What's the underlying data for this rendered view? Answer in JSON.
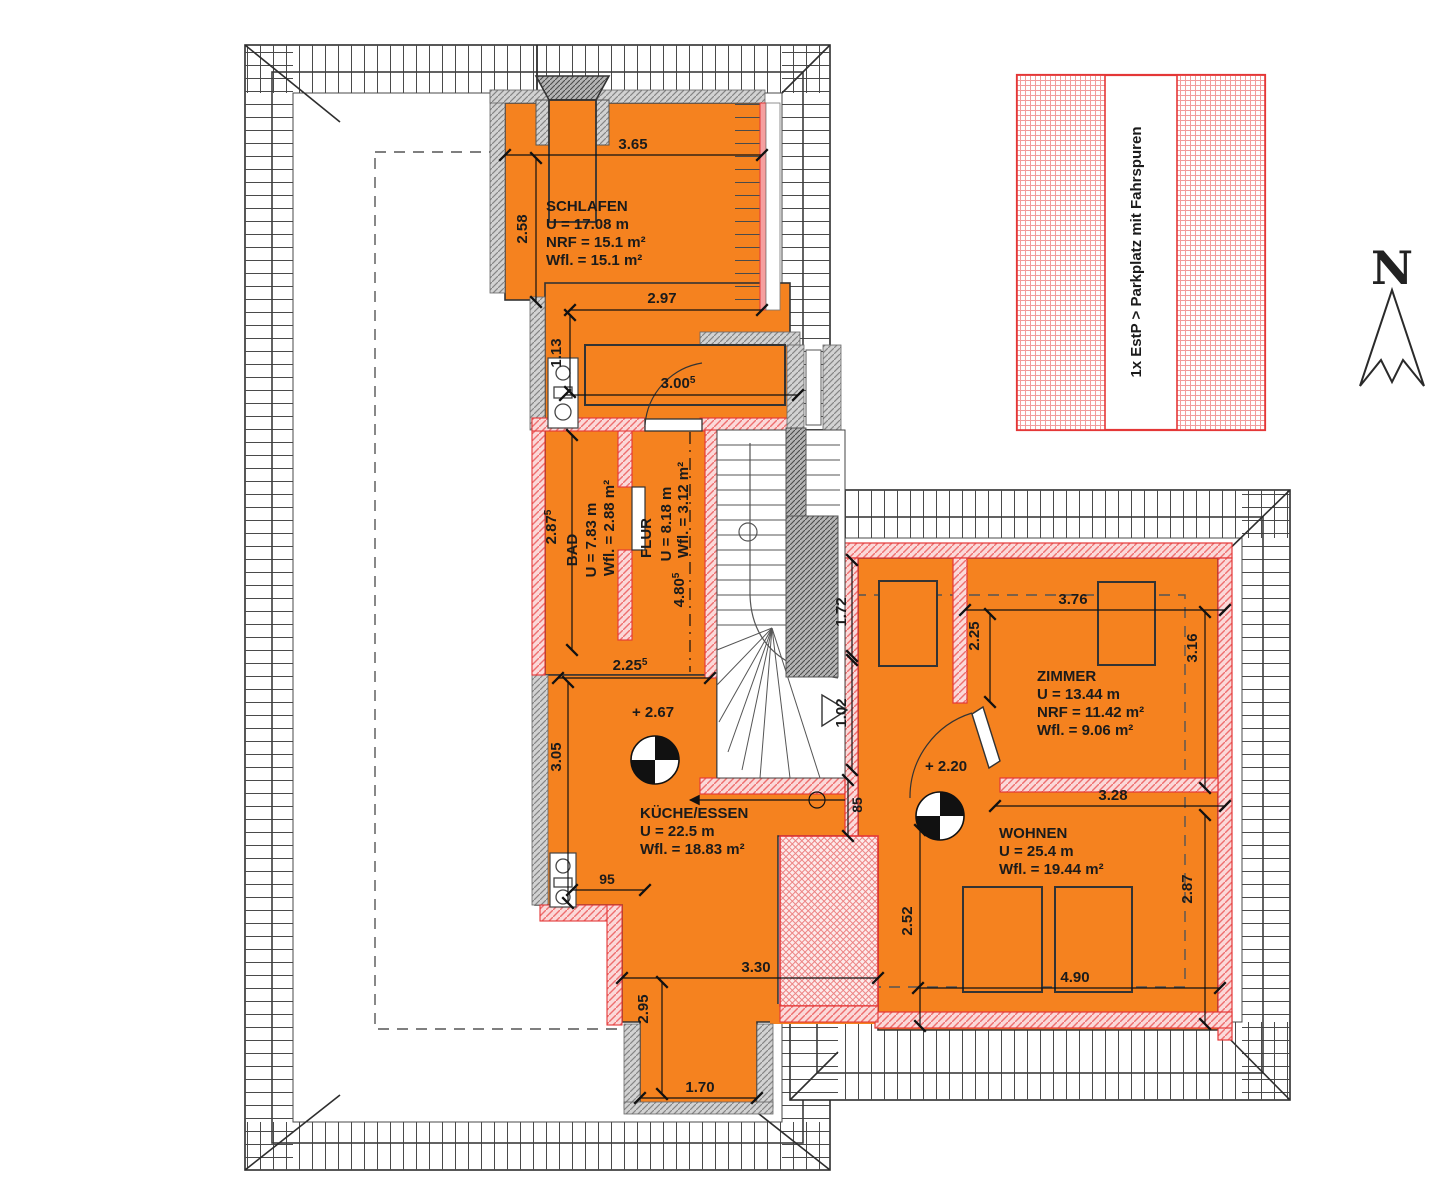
{
  "compass": {
    "label": "N"
  },
  "legend": {
    "parking": "1x EstP > Parkplatz mit Fahrspuren"
  },
  "levels": {
    "kueche": "+ 2.67",
    "diele": "+ 2.20"
  },
  "rooms": {
    "schlafen": {
      "name": "SCHLAFEN",
      "l1": "U = 17.08 m",
      "l2": "NRF = 15.1 m²",
      "l3": "Wfl. = 15.1 m²"
    },
    "bad": {
      "name": "BAD",
      "l1": "U = 7.83 m",
      "l2": "Wfl. = 2.88 m²"
    },
    "flur": {
      "name": "FLUR",
      "l1": "U = 8.18 m",
      "l2": "Wfl. = 3.12 m²"
    },
    "kueche": {
      "name": "KÜCHE/ESSEN",
      "l1": "U = 22.5 m",
      "l2": "Wfl. = 18.83 m²"
    },
    "zimmer": {
      "name": "ZIMMER",
      "l1": "U = 13.44 m",
      "l2": "NRF = 11.42 m²",
      "l3": "Wfl. = 9.06 m²"
    },
    "wohnen": {
      "name": "WOHNEN",
      "l1": "U = 25.4 m",
      "l2": "Wfl. = 19.44 m²"
    }
  },
  "dims": {
    "schlafen_top": "3.65",
    "schlafen_left": "2.58",
    "schlafen_inner": "2.97",
    "schlafen_step": "1.13",
    "wardrobe": {
      "v": "3.00",
      "s": "5"
    },
    "bad_height": {
      "v": "2.87",
      "s": "5"
    },
    "flur_height": {
      "v": "4.80",
      "s": "5"
    },
    "kueche_top": {
      "v": "2.25",
      "s": "5"
    },
    "kueche_left": "3.05",
    "kueche_small": "95",
    "stair_upper": "1.72",
    "stair_lower": "1.02",
    "hall_small": "85",
    "zimmer_top": "3.76",
    "zimmer_left": "2.25",
    "zimmer_right": "3.16",
    "wohnen_top": "3.28",
    "wohnen_left": "2.52",
    "wohnen_right": "2.87",
    "wohnen_bottom": "4.90",
    "kueche_bottom": "3.30",
    "kueche_ext": "2.95",
    "chimney_w": "1.70"
  }
}
